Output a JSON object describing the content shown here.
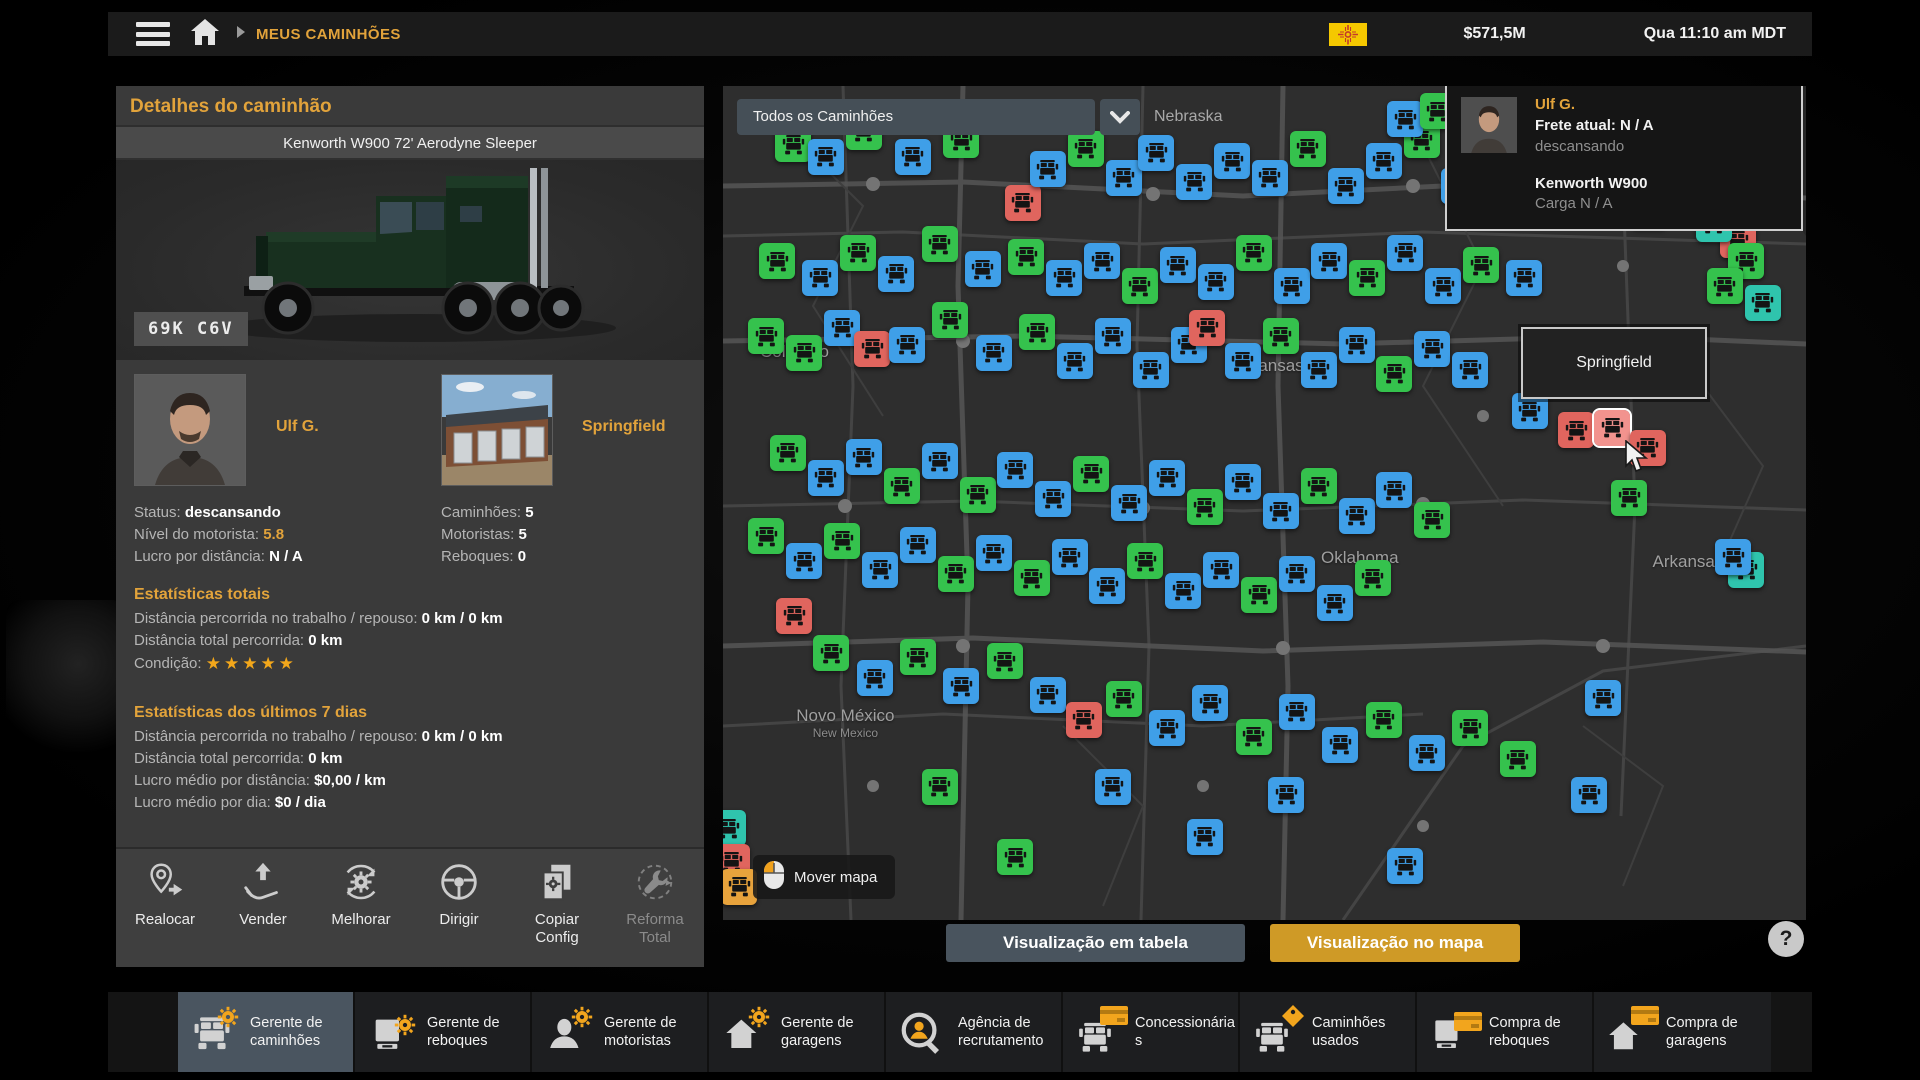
{
  "top_bar": {
    "breadcrumb": "MEUS CAMINHÕES",
    "money": "$571,5M",
    "datetime": "Qua 11:10 am MDT"
  },
  "details": {
    "panel_title": "Detalhes do caminhão",
    "truck_name": "Kenworth W900 72' Aerodyne Sleeper",
    "plate": "69K C6V",
    "driver": {
      "name": "Ulf G.",
      "rows": [
        {
          "label": "Status: ",
          "value": "descansando"
        },
        {
          "label": "Nível do motorista: ",
          "value": "5.8"
        },
        {
          "label": "Lucro por distância: ",
          "value": "N / A"
        }
      ]
    },
    "garage": {
      "name": "Springfield",
      "rows": [
        {
          "label": "Caminhões: ",
          "value": "5"
        },
        {
          "label": "Motoristas: ",
          "value": "5"
        },
        {
          "label": "Reboques: ",
          "value": "0"
        }
      ]
    },
    "stats_total": {
      "title": "Estatísticas totais",
      "rows": [
        {
          "label": "Distância percorrida no trabalho / repouso: ",
          "value": "0 km / 0 km"
        },
        {
          "label": "Distância total percorrida: ",
          "value": "0 km"
        }
      ],
      "condition_label": "Condição: ",
      "condition_stars": "★★★★★"
    },
    "stats_week": {
      "title": "Estatísticas dos últimos 7 dias",
      "rows": [
        {
          "label": "Distância percorrida no trabalho / repouso: ",
          "value": "0 km / 0 km"
        },
        {
          "label": "Distância total percorrida: ",
          "value": "0 km"
        },
        {
          "label": "Lucro médio por distância: ",
          "value": "$0,00 / km"
        },
        {
          "label": "Lucro médio por dia: ",
          "value": "$0 / dia"
        }
      ]
    },
    "actions": [
      {
        "label": "Realocar",
        "enabled": true
      },
      {
        "label": "Vender",
        "enabled": true
      },
      {
        "label": "Melhorar",
        "enabled": true
      },
      {
        "label": "Dirigir",
        "enabled": true
      },
      {
        "label": "Copiar Config",
        "enabled": true
      },
      {
        "label": "Reforma Total",
        "enabled": false
      }
    ]
  },
  "map": {
    "filter": "Todos os Caminhões",
    "region_label": "Nebraska",
    "tooltip": "Springfield",
    "move_map": "Mover mapa",
    "view_table": "Visualização em tabela",
    "view_map": "Visualização no mapa",
    "help": "?",
    "driver_card": {
      "name": "Ulf G.",
      "freight": "Frete atual: N / A",
      "status": "descansando",
      "truck": "Kenworth W900",
      "cargo": "Carga N / A"
    },
    "states": [
      {
        "name": "Colorado",
        "x": 6.6,
        "y": 31.9
      },
      {
        "name": "Kansas",
        "x": 51.0,
        "y": 33.6
      },
      {
        "name": "Oklahoma",
        "x": 58.8,
        "y": 56.6
      },
      {
        "name": "Novo México",
        "sub": "New Mexico",
        "x": 11.3,
        "y": 76.4
      },
      {
        "name": "Arkansas",
        "x": 89.1,
        "y": 57.1
      }
    ],
    "markers": [
      {
        "x": 6.5,
        "y": 7,
        "c": "g"
      },
      {
        "x": 9.5,
        "y": 8.5,
        "c": "b"
      },
      {
        "x": 13,
        "y": 5.5,
        "c": "g"
      },
      {
        "x": 17.5,
        "y": 8.5,
        "c": "b"
      },
      {
        "x": 22,
        "y": 6.5,
        "c": "g"
      },
      {
        "x": 27.7,
        "y": 14,
        "c": "r"
      },
      {
        "x": 30,
        "y": 10,
        "c": "b"
      },
      {
        "x": 33.5,
        "y": 7.5,
        "c": "g"
      },
      {
        "x": 37,
        "y": 11,
        "c": "b"
      },
      {
        "x": 40,
        "y": 8,
        "c": "b"
      },
      {
        "x": 43.5,
        "y": 11.5,
        "c": "b"
      },
      {
        "x": 47,
        "y": 9,
        "c": "b"
      },
      {
        "x": 50.5,
        "y": 11,
        "c": "b"
      },
      {
        "x": 54,
        "y": 7.5,
        "c": "g"
      },
      {
        "x": 57.5,
        "y": 12,
        "c": "b"
      },
      {
        "x": 61,
        "y": 9,
        "c": "b"
      },
      {
        "x": 64.5,
        "y": 6.5,
        "c": "g"
      },
      {
        "x": 68,
        "y": 12,
        "c": "b"
      },
      {
        "x": 71.5,
        "y": 9.5,
        "c": "b"
      },
      {
        "x": 76,
        "y": 13,
        "c": "b"
      },
      {
        "x": 81,
        "y": 11,
        "c": "g"
      },
      {
        "x": 85.5,
        "y": 15,
        "c": "b"
      },
      {
        "x": 89,
        "y": 12,
        "c": "g"
      },
      {
        "x": 63,
        "y": 4,
        "c": "b"
      },
      {
        "x": 66,
        "y": 3,
        "c": "g"
      },
      {
        "x": 93.7,
        "y": 18.5,
        "c": "r"
      },
      {
        "x": 91.5,
        "y": 16.5,
        "c": "t"
      },
      {
        "x": 94.5,
        "y": 21,
        "c": "g"
      },
      {
        "x": 92.5,
        "y": 24,
        "c": "g"
      },
      {
        "x": 96,
        "y": 26,
        "c": "t"
      },
      {
        "x": 5,
        "y": 21,
        "c": "g"
      },
      {
        "x": 9,
        "y": 23,
        "c": "b"
      },
      {
        "x": 12.5,
        "y": 20,
        "c": "g"
      },
      {
        "x": 16,
        "y": 22.5,
        "c": "b"
      },
      {
        "x": 20,
        "y": 19,
        "c": "g"
      },
      {
        "x": 24,
        "y": 22,
        "c": "b"
      },
      {
        "x": 28,
        "y": 20.5,
        "c": "g"
      },
      {
        "x": 31.5,
        "y": 23,
        "c": "b"
      },
      {
        "x": 35,
        "y": 21,
        "c": "b"
      },
      {
        "x": 38.5,
        "y": 24,
        "c": "g"
      },
      {
        "x": 42,
        "y": 21.5,
        "c": "b"
      },
      {
        "x": 45.5,
        "y": 23.5,
        "c": "b"
      },
      {
        "x": 49,
        "y": 20,
        "c": "g"
      },
      {
        "x": 52.5,
        "y": 24,
        "c": "b"
      },
      {
        "x": 56,
        "y": 21,
        "c": "b"
      },
      {
        "x": 59.5,
        "y": 23,
        "c": "g"
      },
      {
        "x": 63,
        "y": 20,
        "c": "b"
      },
      {
        "x": 66.5,
        "y": 24,
        "c": "b"
      },
      {
        "x": 70,
        "y": 21.5,
        "c": "g"
      },
      {
        "x": 74,
        "y": 23,
        "c": "b"
      },
      {
        "x": 4,
        "y": 30,
        "c": "g"
      },
      {
        "x": 7.5,
        "y": 32,
        "c": "g"
      },
      {
        "x": 11,
        "y": 29,
        "c": "b"
      },
      {
        "x": 13.8,
        "y": 31.5,
        "c": "r"
      },
      {
        "x": 17,
        "y": 31,
        "c": "b"
      },
      {
        "x": 21,
        "y": 28,
        "c": "g"
      },
      {
        "x": 25,
        "y": 32,
        "c": "b"
      },
      {
        "x": 29,
        "y": 29.5,
        "c": "g"
      },
      {
        "x": 32.5,
        "y": 33,
        "c": "b"
      },
      {
        "x": 36,
        "y": 30,
        "c": "b"
      },
      {
        "x": 39.5,
        "y": 34,
        "c": "b"
      },
      {
        "x": 43,
        "y": 31,
        "c": "b"
      },
      {
        "x": 44.7,
        "y": 29,
        "c": "r"
      },
      {
        "x": 48,
        "y": 33,
        "c": "b"
      },
      {
        "x": 51.5,
        "y": 30,
        "c": "g"
      },
      {
        "x": 55,
        "y": 34,
        "c": "b"
      },
      {
        "x": 58.5,
        "y": 31,
        "c": "b"
      },
      {
        "x": 62,
        "y": 34.5,
        "c": "g"
      },
      {
        "x": 65.5,
        "y": 31.5,
        "c": "b"
      },
      {
        "x": 69,
        "y": 34,
        "c": "b"
      },
      {
        "x": 88,
        "y": 34,
        "c": "g"
      },
      {
        "x": 78.8,
        "y": 41.3,
        "c": "r"
      },
      {
        "x": 82.1,
        "y": 41,
        "c": "rh"
      },
      {
        "x": 85.4,
        "y": 43.4,
        "c": "r"
      },
      {
        "x": 83.7,
        "y": 49.4,
        "c": "g"
      },
      {
        "x": 74.5,
        "y": 39,
        "c": "b"
      },
      {
        "x": 6,
        "y": 44,
        "c": "g"
      },
      {
        "x": 9.5,
        "y": 47,
        "c": "b"
      },
      {
        "x": 13,
        "y": 44.5,
        "c": "b"
      },
      {
        "x": 16.5,
        "y": 48,
        "c": "g"
      },
      {
        "x": 20,
        "y": 45,
        "c": "b"
      },
      {
        "x": 23.5,
        "y": 49,
        "c": "g"
      },
      {
        "x": 27,
        "y": 46,
        "c": "b"
      },
      {
        "x": 30.5,
        "y": 49.5,
        "c": "b"
      },
      {
        "x": 34,
        "y": 46.5,
        "c": "g"
      },
      {
        "x": 37.5,
        "y": 50,
        "c": "b"
      },
      {
        "x": 41,
        "y": 47,
        "c": "b"
      },
      {
        "x": 44.5,
        "y": 50.5,
        "c": "g"
      },
      {
        "x": 48,
        "y": 47.5,
        "c": "b"
      },
      {
        "x": 51.5,
        "y": 51,
        "c": "b"
      },
      {
        "x": 55,
        "y": 48,
        "c": "g"
      },
      {
        "x": 58.5,
        "y": 51.5,
        "c": "b"
      },
      {
        "x": 62,
        "y": 48.5,
        "c": "b"
      },
      {
        "x": 65.5,
        "y": 52,
        "c": "g"
      },
      {
        "x": 94.5,
        "y": 58,
        "c": "t"
      },
      {
        "x": 93.3,
        "y": 56.5,
        "c": "b"
      },
      {
        "x": 6.6,
        "y": 63.5,
        "c": "r"
      },
      {
        "x": 4,
        "y": 54,
        "c": "g"
      },
      {
        "x": 7.5,
        "y": 57,
        "c": "b"
      },
      {
        "x": 11,
        "y": 54.5,
        "c": "g"
      },
      {
        "x": 14.5,
        "y": 58,
        "c": "b"
      },
      {
        "x": 18,
        "y": 55,
        "c": "b"
      },
      {
        "x": 21.5,
        "y": 58.5,
        "c": "g"
      },
      {
        "x": 25,
        "y": 56,
        "c": "b"
      },
      {
        "x": 28.5,
        "y": 59,
        "c": "g"
      },
      {
        "x": 32,
        "y": 56.5,
        "c": "b"
      },
      {
        "x": 35.5,
        "y": 60,
        "c": "b"
      },
      {
        "x": 39,
        "y": 57,
        "c": "g"
      },
      {
        "x": 42.5,
        "y": 60.5,
        "c": "b"
      },
      {
        "x": 46,
        "y": 58,
        "c": "b"
      },
      {
        "x": 49.5,
        "y": 61,
        "c": "g"
      },
      {
        "x": 53,
        "y": 58.5,
        "c": "b"
      },
      {
        "x": 56.5,
        "y": 62,
        "c": "b"
      },
      {
        "x": 60,
        "y": 59,
        "c": "g"
      },
      {
        "x": 81.3,
        "y": 73.4,
        "c": "b"
      },
      {
        "x": 73.4,
        "y": 80.7,
        "c": "g"
      },
      {
        "x": 80,
        "y": 85,
        "c": "b"
      },
      {
        "x": 10,
        "y": 68,
        "c": "g"
      },
      {
        "x": 14,
        "y": 71,
        "c": "b"
      },
      {
        "x": 18,
        "y": 68.5,
        "c": "g"
      },
      {
        "x": 22,
        "y": 72,
        "c": "b"
      },
      {
        "x": 26,
        "y": 69,
        "c": "g"
      },
      {
        "x": 30,
        "y": 73,
        "c": "b"
      },
      {
        "x": 33.3,
        "y": 76,
        "c": "r"
      },
      {
        "x": 37,
        "y": 73.5,
        "c": "g"
      },
      {
        "x": 41,
        "y": 77,
        "c": "b"
      },
      {
        "x": 45,
        "y": 74,
        "c": "b"
      },
      {
        "x": 49,
        "y": 78,
        "c": "g"
      },
      {
        "x": 53,
        "y": 75,
        "c": "b"
      },
      {
        "x": 57,
        "y": 79,
        "c": "b"
      },
      {
        "x": 61,
        "y": 76,
        "c": "g"
      },
      {
        "x": 65,
        "y": 80,
        "c": "b"
      },
      {
        "x": 69,
        "y": 77,
        "c": "g"
      },
      {
        "x": 27,
        "y": 92.5,
        "c": "g"
      },
      {
        "x": 44.5,
        "y": 90,
        "c": "b"
      },
      {
        "x": 63,
        "y": 93.5,
        "c": "b"
      },
      {
        "x": 0.5,
        "y": 89,
        "c": "t"
      },
      {
        "x": 0.8,
        "y": 93,
        "c": "r"
      },
      {
        "x": 1.5,
        "y": 96,
        "c": "o"
      },
      {
        "x": 20,
        "y": 84,
        "c": "g"
      },
      {
        "x": 36,
        "y": 84,
        "c": "b"
      },
      {
        "x": 52,
        "y": 85,
        "c": "b"
      }
    ]
  },
  "toolbar": {
    "items": [
      {
        "label": "Gerente de caminhões",
        "selected": true
      },
      {
        "label": "Gerente de reboques",
        "selected": false
      },
      {
        "label": "Gerente de motoristas",
        "selected": false
      },
      {
        "label": "Gerente de garagens",
        "selected": false
      },
      {
        "label": "Agência de recrutamento",
        "selected": false
      },
      {
        "label": "Concessionárias",
        "selected": false
      },
      {
        "label": "Caminhões usados",
        "selected": false
      },
      {
        "label": "Compra de reboques",
        "selected": false
      },
      {
        "label": "Compra de garagens",
        "selected": false
      }
    ]
  },
  "colors": {
    "accent": "#e2a33b",
    "button_gold": "#cf9a26",
    "button_slate": "#49545e",
    "star_gold": "#f2a71b",
    "markers": {
      "b": "#3f9fe8",
      "g": "#35c24d",
      "r": "#e0655e",
      "rh": "#f2938e",
      "t": "#2fc4ad",
      "o": "#e8a33c"
    }
  }
}
